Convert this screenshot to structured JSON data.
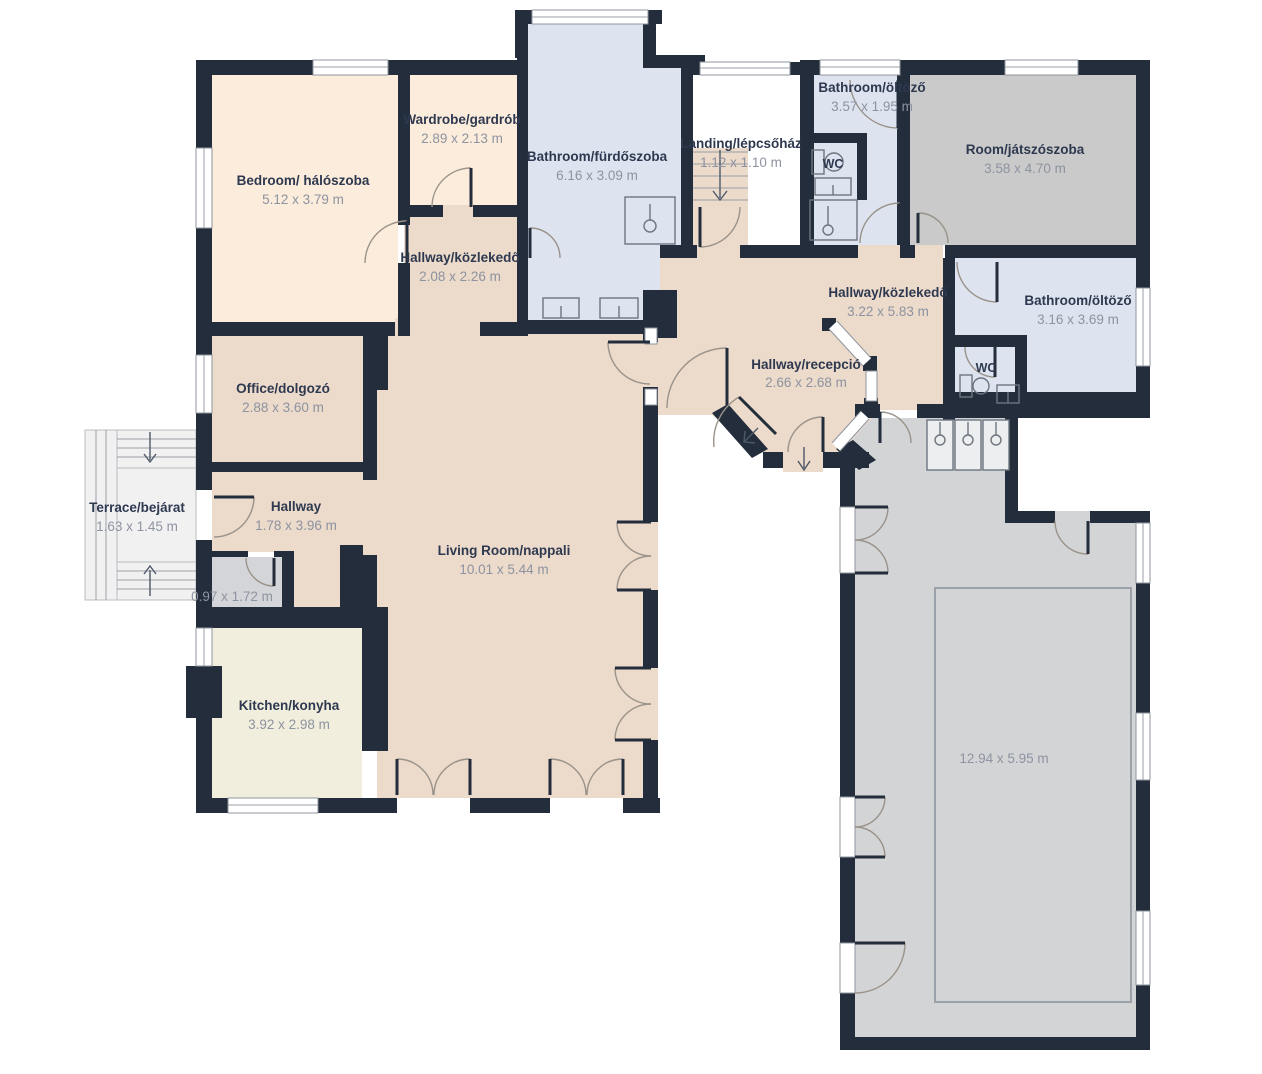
{
  "plan": {
    "type": "floorplan",
    "units": "m"
  },
  "colors": {
    "wall": "#232d3b",
    "room_peach": "#fcecdb",
    "room_tan": "#ecdacb",
    "room_blue": "#dde3ef",
    "room_gray": "#c9cac9",
    "room_pool": "#d3d4d6",
    "room_cream": "#f2eedd",
    "room_pantry": "#d4d5d8",
    "room_terrace": "#f1f1f2",
    "label": "#2e3950",
    "dim": "#8d93a0",
    "door": "#9a938a",
    "fixture": "#6e7580",
    "stair": "#9aa0a7"
  },
  "rooms": [
    {
      "id": "bedroom",
      "name": "Bedroom/ hálószoba",
      "dims": "5.12 x 3.79 m"
    },
    {
      "id": "wardrobe",
      "name": "Wardrobe/gardrób",
      "dims": "2.89 x 2.13 m"
    },
    {
      "id": "bathroom-main",
      "name": "Bathroom/fürdőszoba",
      "dims": "6.16 x 3.09 m"
    },
    {
      "id": "landing",
      "name": "Landing/lépcsőház",
      "dims": "1.12 x 1.10 m"
    },
    {
      "id": "bathroom-top",
      "name": "Bathroom/öltöző",
      "dims": "3.57 x 1.95 m"
    },
    {
      "id": "playroom",
      "name": "Room/játszószoba",
      "dims": "3.58 x 4.70 m"
    },
    {
      "id": "hallway-small",
      "name": "Hallway/közlekedő",
      "dims": "2.08 x 2.26 m"
    },
    {
      "id": "hallway-main",
      "name": "Hallway/közlekedő",
      "dims": "3.22 x 5.83 m"
    },
    {
      "id": "bathroom-right",
      "name": "Bathroom/öltöző",
      "dims": "3.16 x 3.69 m"
    },
    {
      "id": "reception",
      "name": "Hallway/recepció",
      "dims": "2.66 x 2.68 m"
    },
    {
      "id": "office",
      "name": "Office/dolgozó",
      "dims": "2.88 x 3.60 m"
    },
    {
      "id": "terrace",
      "name": "Terrace/bejárat",
      "dims": "1.63 x 1.45 m"
    },
    {
      "id": "hallway-entry",
      "name": "Hallway",
      "dims": "1.78 x 3.96 m"
    },
    {
      "id": "living-room",
      "name": "Living Room/nappali",
      "dims": "10.01 x 5.44 m"
    },
    {
      "id": "pantry",
      "name": "",
      "dims": "0.97 x 1.72 m"
    },
    {
      "id": "kitchen",
      "name": "Kitchen/konyha",
      "dims": "3.92 x 2.98 m"
    },
    {
      "id": "pool-room",
      "name": "",
      "dims": "12.94 x 5.95 m"
    },
    {
      "id": "wc-top",
      "name": "WC",
      "dims": ""
    },
    {
      "id": "wc-right",
      "name": "WC",
      "dims": ""
    }
  ]
}
